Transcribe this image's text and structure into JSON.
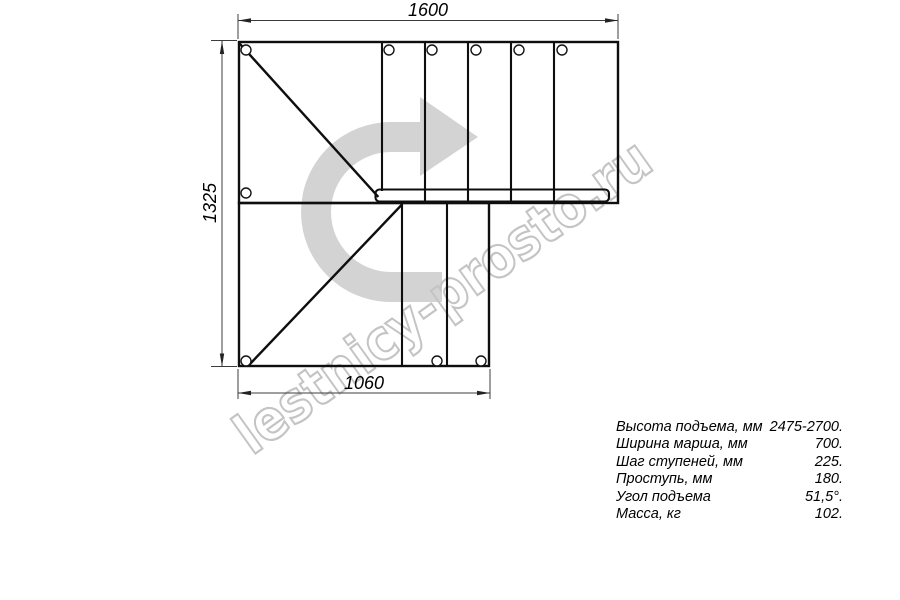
{
  "watermark": {
    "text": "lestnicy-prosto.ru"
  },
  "drawing": {
    "dim_top": "1600",
    "dim_left": "1325",
    "dim_bottom": "1060"
  },
  "specs": {
    "rows": [
      {
        "label": "Высота подъема, мм",
        "value": "2475-2700."
      },
      {
        "label": "Ширина марша, мм",
        "value": "700."
      },
      {
        "label": "Шаг ступеней, мм",
        "value": "225."
      },
      {
        "label": "Проступь, мм",
        "value": "180."
      },
      {
        "label": "Угол подъема",
        "value": "51,5°."
      },
      {
        "label": "Масса, кг",
        "value": "102."
      }
    ]
  },
  "colors": {
    "line": "#0e0e0e",
    "dimension": "#3c3c3c",
    "arrow_gray": "#d3d3d3",
    "watermark_gray": "#c4c4c4",
    "background": "#ffffff"
  }
}
